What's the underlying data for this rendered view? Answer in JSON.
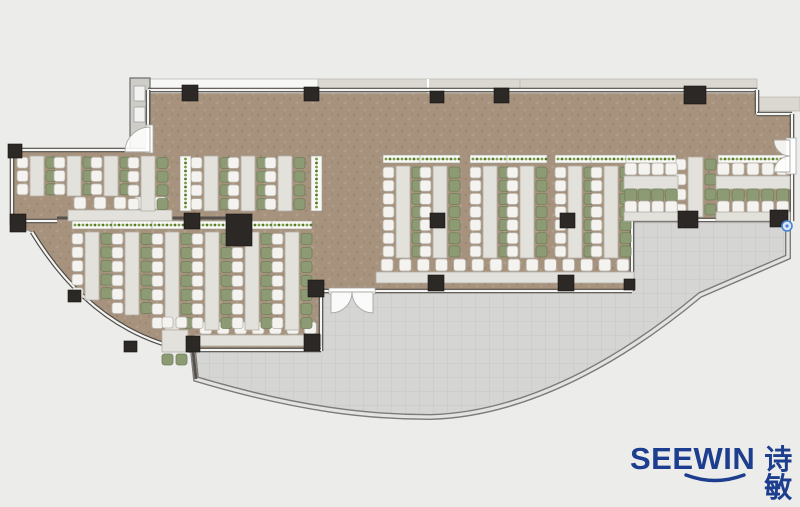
{
  "logo": {
    "wordmark": "SEEWIN",
    "chinese": "诗敏",
    "color": "#1d3e8e"
  },
  "palette": {
    "bg": "#ececeb",
    "floor": "#a6927d",
    "floorDot1": "#93806b",
    "floorDot2": "#b9a78f",
    "floorDot3": "#8d7a66",
    "terrace": "#d5d5d3",
    "terraceLine": "#c7c7c5",
    "wallDark": "#504d49",
    "wallLight": "#f5f5f3",
    "curveDark": "#7d7b78",
    "curveLight": "#e3e3e1",
    "column": "#2b2825",
    "desk": "#e3e1dc",
    "deskStroke": "#b3b0a8",
    "chairWhite": "#f4f3ef",
    "chairWhiteStroke": "#b6b3ab",
    "chairGreen": "#8d9b75",
    "chairGreenStroke": "#70805a",
    "planterBox": "#f8f8f4",
    "planterDot1": "#55772e",
    "planterDot2": "#7a9c43",
    "counter": "#dcdad4",
    "deckGray": "#dbd8d2",
    "deckWhite": "#f7f7f5",
    "shaft": "#cfcdc7",
    "door": "#ffffff",
    "doorStroke": "#a9a7a2",
    "marker": "#4a86d8"
  },
  "plan": {
    "floorPath": "M148,88 L757,88 L757,114 L792,114 L792,220 L632,220 L632,291 L321,291 L321,351 L196,351 Q95,335 32,232 L12,224 L12,150 L148,150 Z",
    "terracePath": "M196,351 L321,351 L321,291 L632,291 L632,220 L788,220 L788,257 L700,295 C640,345 540,414 430,417 C370,417 300,410 196,379 Z",
    "outerCurve": "M788,221 L788,257 L700,295 C640,345 540,414 430,417 C370,417 300,410 196,379 L193,350",
    "swWall": "M193,351 Q95,335 32,232",
    "deck": [
      {
        "x": 150,
        "y": 79,
        "w": 168,
        "h": 14,
        "k": "white"
      },
      {
        "x": 318,
        "y": 79,
        "w": 202,
        "h": 14,
        "k": "gray"
      },
      {
        "x": 520,
        "y": 79,
        "w": 237,
        "h": 14,
        "k": "gray"
      },
      {
        "x": 758,
        "y": 97,
        "w": 42,
        "h": 14,
        "k": "gray"
      }
    ],
    "shaft": {
      "x": 130,
      "y": 78,
      "w": 20,
      "h": 72,
      "fixtures": [
        [
          134,
          86,
          11,
          15
        ],
        [
          134,
          107,
          11,
          15
        ]
      ]
    },
    "wallsWin": [
      [
        148,
        90,
        757,
        90
      ],
      [
        757,
        90,
        757,
        114
      ],
      [
        757,
        114,
        792,
        114
      ],
      [
        792,
        114,
        792,
        140
      ],
      [
        792,
        172,
        792,
        221
      ],
      [
        632,
        220,
        790,
        220
      ],
      [
        632,
        220,
        632,
        291
      ],
      [
        373,
        291,
        632,
        291
      ],
      [
        321,
        291,
        331,
        291
      ],
      [
        321,
        291,
        321,
        351
      ],
      [
        188,
        350,
        321,
        350
      ],
      [
        12,
        150,
        148,
        150
      ],
      [
        12,
        146,
        12,
        225
      ],
      [
        12,
        221,
        57,
        221
      ],
      [
        148,
        90,
        148,
        126
      ]
    ],
    "wallsSolid": [
      [
        57,
        218,
        228,
        218
      ],
      [
        193,
        351,
        196,
        379
      ]
    ],
    "columns": [
      [
        182,
        85,
        16,
        16
      ],
      [
        304,
        87,
        15,
        14
      ],
      [
        430,
        91,
        14,
        12
      ],
      [
        494,
        88,
        15,
        15
      ],
      [
        684,
        86,
        22,
        18
      ],
      [
        8,
        144,
        14,
        14
      ],
      [
        10,
        214,
        16,
        18
      ],
      [
        226,
        214,
        26,
        32
      ],
      [
        184,
        213,
        16,
        16
      ],
      [
        430,
        213,
        15,
        15
      ],
      [
        560,
        213,
        15,
        15
      ],
      [
        678,
        211,
        20,
        17
      ],
      [
        770,
        210,
        18,
        17
      ],
      [
        308,
        280,
        16,
        17
      ],
      [
        428,
        275,
        16,
        16
      ],
      [
        558,
        275,
        16,
        16
      ],
      [
        624,
        279,
        11,
        11
      ],
      [
        186,
        336,
        14,
        16
      ],
      [
        304,
        334,
        16,
        17
      ],
      [
        124,
        341,
        13,
        11
      ],
      [
        68,
        290,
        13,
        12
      ]
    ],
    "vstrips": [
      [
        30,
        156,
        40,
        3,
        0
      ],
      [
        67,
        156,
        40,
        3,
        0
      ],
      [
        104,
        156,
        40,
        3,
        0
      ],
      [
        141,
        156,
        55,
        4,
        0
      ],
      [
        204,
        156,
        55,
        4,
        0
      ],
      [
        241,
        156,
        55,
        4,
        0
      ],
      [
        278,
        156,
        55,
        4,
        0
      ],
      [
        85,
        232,
        68,
        5,
        1
      ],
      [
        125,
        232,
        83,
        6,
        1
      ],
      [
        165,
        232,
        98,
        7,
        1
      ],
      [
        205,
        232,
        98,
        7,
        1
      ],
      [
        245,
        232,
        98,
        7,
        1
      ],
      [
        285,
        232,
        98,
        7,
        1
      ],
      [
        396,
        166,
        92,
        7,
        1
      ],
      [
        433,
        166,
        92,
        7,
        1
      ],
      [
        483,
        166,
        92,
        7,
        1
      ],
      [
        520,
        166,
        92,
        7,
        1
      ],
      [
        568,
        166,
        92,
        7,
        1
      ],
      [
        604,
        166,
        92,
        7,
        1
      ]
    ],
    "plantersV": [
      [
        180,
        156,
        11,
        55
      ],
      [
        311,
        156,
        11,
        55
      ]
    ],
    "rvstrip": {
      "x": 688,
      "y": 157,
      "len": 60,
      "n": 4
    },
    "hclusters": [
      {
        "x": 624,
        "w": 54,
        "n": 4
      },
      {
        "x": 716,
        "w": 74,
        "n": 5
      }
    ],
    "benches": [
      {
        "x": 378,
        "y": 259,
        "w": 254,
        "n": 14
      },
      {
        "x": 197,
        "y": 322,
        "w": 122,
        "n": 7
      },
      {
        "x": 70,
        "y": 197,
        "w": 100,
        "n": 5
      }
    ],
    "smallTable": {
      "x": 162,
      "y": 330,
      "w": 26,
      "h": 22
    },
    "doors": {
      "thresholds": [
        [
          146,
          125,
          7,
          28
        ],
        [
          329,
          288,
          46,
          6
        ],
        [
          786,
          138,
          10,
          36
        ]
      ],
      "fans": [
        "M150,152 L150,127 A25,25 0 0 0 125,152 Z",
        "M331,292 L352,292 A21,21 0 0 1 331,313 Z",
        "M373,292 L352,292 A21,21 0 0 0 373,313 Z",
        "M790,140 L790,156 A16,16 0 0 1 774,140 Z",
        "M790,172 L774,172 A16,16 0 0 1 790,156 Z"
      ]
    },
    "marker": {
      "cx": 787,
      "cy": 226,
      "r": 5
    }
  }
}
